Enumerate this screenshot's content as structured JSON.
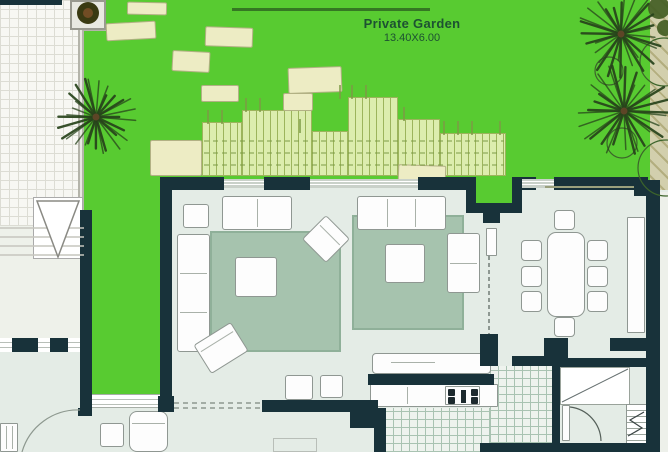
{
  "garden": {
    "label": "Private Garden",
    "size": "13.40X6.00"
  },
  "colors": {
    "garden_green": "#58cb31",
    "wall_dark": "#18323a",
    "floor": "#e4ece6",
    "rug": "#a6c3ae",
    "rug_border": "#8fb099",
    "pergola": "#dcedae",
    "pergola_line": "#9cb45c",
    "stone": "#edecc4",
    "stone_border": "#b2b184",
    "tile_bg": "#eef3ee",
    "tile_line": "#a9c3b2",
    "paving_bg": "#f7f7f3",
    "paving_line": "#dcdcd4",
    "furniture": "#fdfdfd",
    "furniture_border": "#8f9792",
    "palm_green": "#27431b",
    "label_text": "#1d5132",
    "tan_path": "#d2cfad",
    "glazing": "#c9d1c9"
  }
}
